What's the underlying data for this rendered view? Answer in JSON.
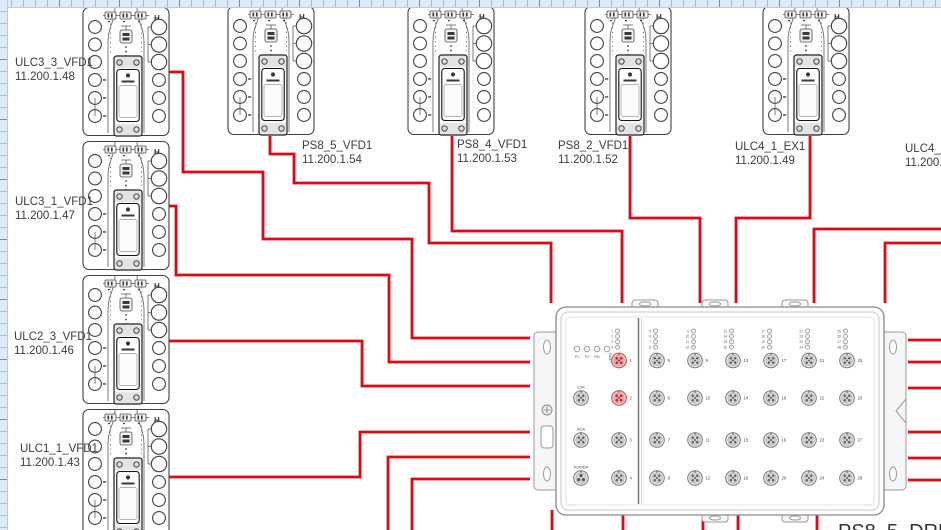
{
  "app": {
    "type": "cad-wiring-diagram"
  },
  "colors": {
    "cable": "#e30613",
    "ruler_bg": "#dcebf7",
    "canvas_bg": "#ffffff",
    "highlight_port": "#c9504c"
  },
  "devices": [
    {
      "label": "ULC3_3_VFD1",
      "ip": "11.200.1.48",
      "x": 82,
      "y": 6
    },
    {
      "label": "PS8_5_VFD1",
      "ip": "11.200.1.54",
      "x": 227,
      "y": 5
    },
    {
      "label": "PS8_4_VFD1",
      "ip": "11.200.1.53",
      "x": 407,
      "y": 5
    },
    {
      "label": "PS8_2_VFD1",
      "ip": "11.200.1.52",
      "x": 584,
      "y": 5
    },
    {
      "label": "ULC4_1_EX1",
      "ip": "11.200.1.49",
      "x": 762,
      "y": 5
    },
    {
      "label": "ULC3_1_VFD1",
      "ip": "11.200.1.47",
      "x": 82,
      "y": 140
    },
    {
      "label": "ULC2_3_VFD1",
      "ip": "11.200.1.46",
      "x": 82,
      "y": 274
    },
    {
      "label": "ULC1_1_VFD1",
      "ip": "11.200.1.43",
      "x": 82,
      "y": 408
    },
    {
      "label": "ULC4_3_",
      "ip": "11.200.1",
      "x": null,
      "y": null
    }
  ],
  "module": {
    "label": "PS8_5_DRM1",
    "status_leds": [
      "P1",
      "P2",
      "RM",
      "FAULT"
    ],
    "special_ports": [
      {
        "label": "1.2K"
      },
      {
        "label": "ACA"
      },
      {
        "label": "POWER"
      }
    ],
    "led_groups": [
      [
        "1",
        "2",
        "3",
        "4"
      ],
      [
        "5",
        "6",
        "7",
        "8"
      ],
      [
        "9",
        "10",
        "11",
        "12"
      ],
      [
        "13",
        "14",
        "15",
        "16"
      ],
      [
        "17",
        "18",
        "19",
        "20"
      ],
      [
        "21",
        "22",
        "23",
        "24"
      ],
      [
        "25",
        "26",
        "27",
        "28"
      ]
    ],
    "port_numbers": [
      1,
      2,
      3,
      4,
      5,
      6,
      7,
      8,
      9,
      10,
      11,
      12,
      13,
      14,
      15,
      16,
      17,
      18,
      19,
      20,
      21,
      22,
      23,
      24,
      25,
      26,
      27,
      28
    ],
    "pink_ports": [
      1,
      2
    ]
  },
  "wires": [
    [
      [
        169,
        72
      ],
      [
        183,
        72
      ],
      [
        183,
        172
      ],
      [
        263,
        172
      ],
      [
        263,
        239
      ],
      [
        412,
        239
      ],
      [
        412,
        338
      ],
      [
        530,
        338
      ]
    ],
    [
      [
        270,
        136
      ],
      [
        270,
        154
      ],
      [
        294,
        154
      ],
      [
        294,
        183
      ],
      [
        429,
        183
      ],
      [
        429,
        243
      ],
      [
        551,
        243
      ],
      [
        551,
        303
      ]
    ],
    [
      [
        452,
        136
      ],
      [
        452,
        231
      ],
      [
        622,
        231
      ],
      [
        622,
        303
      ]
    ],
    [
      [
        630,
        136
      ],
      [
        630,
        218
      ],
      [
        700,
        218
      ],
      [
        700,
        303
      ]
    ],
    [
      [
        810,
        136
      ],
      [
        810,
        218
      ],
      [
        736,
        218
      ],
      [
        736,
        303
      ]
    ],
    [
      [
        941,
        229
      ],
      [
        814,
        229
      ],
      [
        814,
        303
      ]
    ],
    [
      [
        941,
        243
      ],
      [
        885,
        243
      ],
      [
        885,
        303
      ]
    ],
    [
      [
        169,
        206
      ],
      [
        176,
        206
      ],
      [
        176,
        275
      ],
      [
        389,
        275
      ],
      [
        389,
        362
      ],
      [
        530,
        362
      ]
    ],
    [
      [
        169,
        341
      ],
      [
        362,
        341
      ],
      [
        362,
        386
      ],
      [
        530,
        386
      ]
    ],
    [
      [
        169,
        477
      ],
      [
        360,
        477
      ],
      [
        360,
        432
      ],
      [
        530,
        432
      ]
    ],
    [
      [
        388,
        532
      ],
      [
        388,
        457
      ],
      [
        530,
        457
      ]
    ],
    [
      [
        412,
        532
      ],
      [
        412,
        479
      ],
      [
        530,
        479
      ]
    ],
    [
      [
        941,
        340
      ],
      [
        908,
        340
      ]
    ],
    [
      [
        941,
        362
      ],
      [
        908,
        362
      ]
    ],
    [
      [
        941,
        388
      ],
      [
        908,
        388
      ]
    ],
    [
      [
        941,
        432
      ],
      [
        908,
        432
      ]
    ],
    [
      [
        941,
        458
      ],
      [
        908,
        458
      ]
    ],
    [
      [
        941,
        480
      ],
      [
        908,
        480
      ]
    ],
    [
      [
        552,
        532
      ],
      [
        552,
        510
      ]
    ],
    [
      [
        623,
        532
      ],
      [
        623,
        510
      ]
    ],
    [
      [
        703,
        532
      ],
      [
        703,
        510
      ]
    ],
    [
      [
        738,
        532
      ],
      [
        738,
        510
      ]
    ],
    [
      [
        817,
        532
      ],
      [
        817,
        510
      ]
    ]
  ]
}
